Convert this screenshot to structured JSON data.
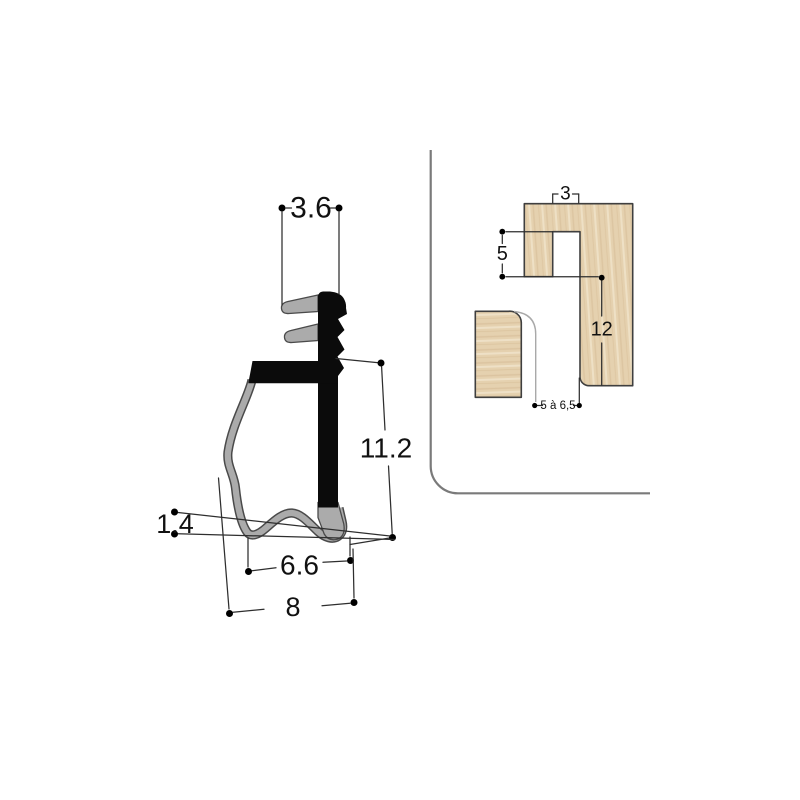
{
  "page": {
    "background": "#ffffff",
    "kind": "technical drawing"
  },
  "left_diagram": {
    "name": "seal profile cross-section",
    "labels": {
      "top_width": "3.6",
      "overall_height": "11.2",
      "lip_thickness": "1.4",
      "inner_width": "6.6",
      "base_width": "8"
    },
    "colors": {
      "rigid_black": "#0b0b0b",
      "flexible_gray": "#ababab",
      "outline": "#4a4a4a"
    }
  },
  "right_diagram": {
    "name": "wood frame groove installation detail",
    "labels": {
      "groove_width": "3",
      "groove_depth": "5",
      "rebate_height": "12",
      "channel_gap": "5 à 6,5"
    },
    "colors": {
      "wood_fill": "#e5d1af",
      "wood_grain_dark": "#d6bc95",
      "wood_grain_light": "#f0e3c9",
      "outline": "#3f3f3f",
      "frame_line": "#7a7a7a"
    }
  },
  "dimension_style": {
    "line_color": "#2e2e2e",
    "dot_color": "#000000",
    "text_color": "#111111"
  }
}
